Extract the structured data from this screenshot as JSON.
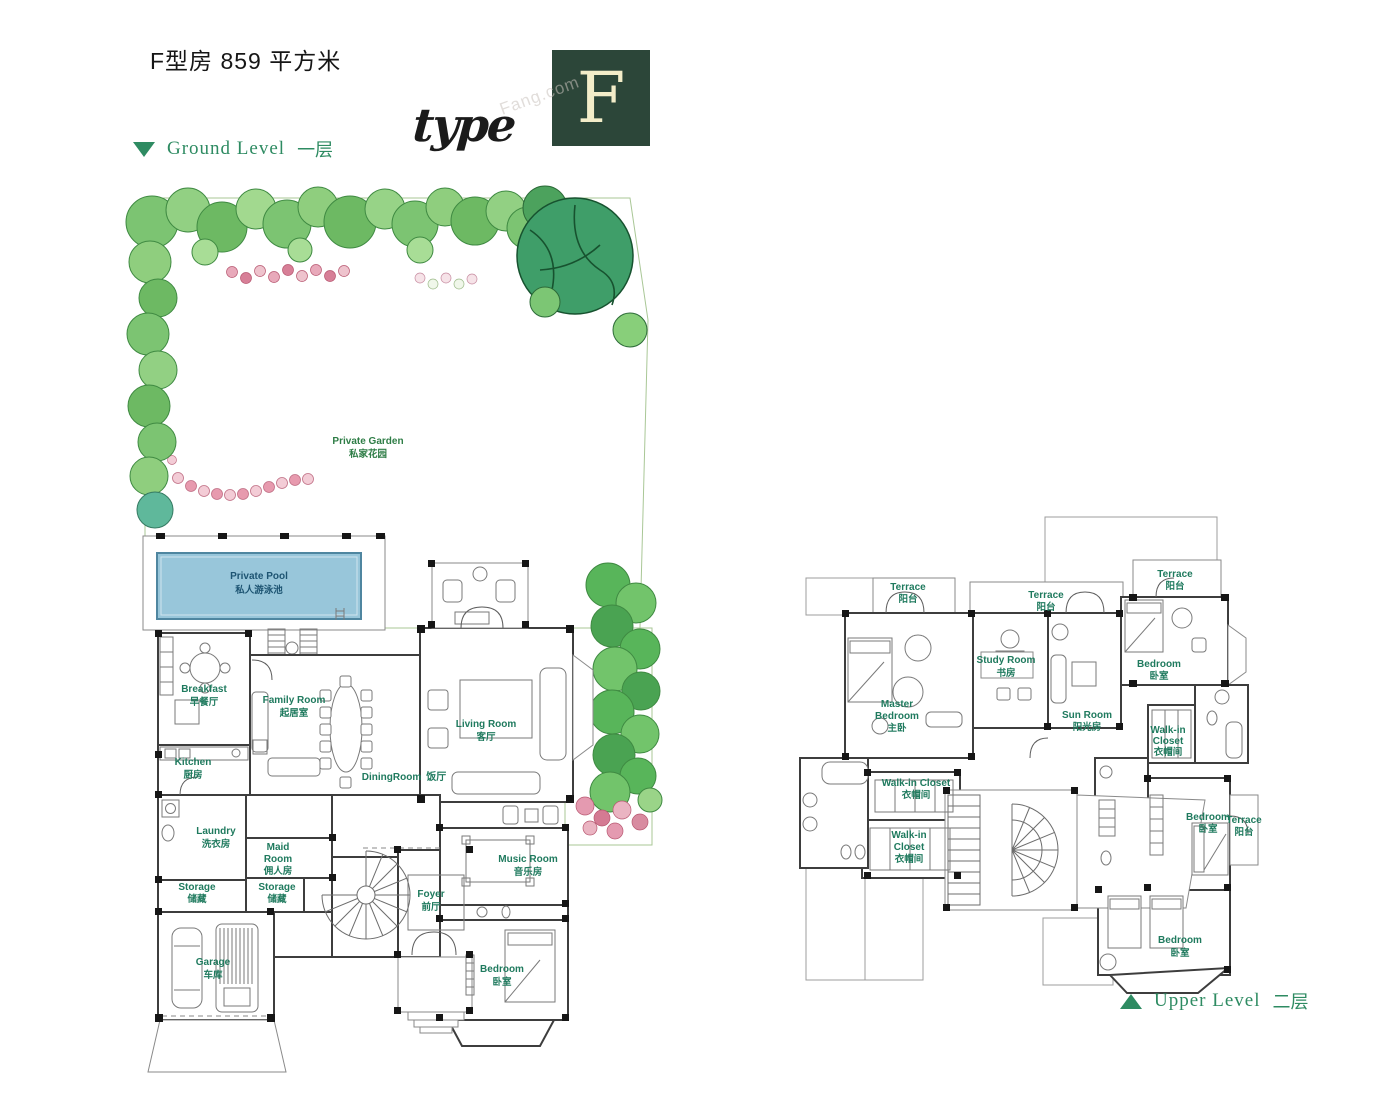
{
  "header": {
    "title": "F型房 859 平方米",
    "type_word": "type",
    "type_letter": "F",
    "watermark": "Fang.com"
  },
  "legend": {
    "ground_en": "Ground Level",
    "ground_zh": "一层",
    "upper_en": "Upper Level",
    "upper_zh": "二层"
  },
  "colors": {
    "accent_green": "#2e8b62",
    "label_green": "#1f7a5e",
    "garden_green": "#2e7d46",
    "pool_blue": "#98c6da",
    "pool_text": "#1d5472",
    "lawn": "#dfeecf",
    "logo_bg": "#2c4639",
    "logo_letter": "#f3edc9"
  },
  "ground": {
    "garden": {
      "en": "Private Garden",
      "zh": "私家花园"
    },
    "pool": {
      "en": "Private Pool",
      "zh": "私人游泳池"
    },
    "breakfast": {
      "en": "Breakfast",
      "zh": "早餐厅"
    },
    "family_room": {
      "en": "Family Room",
      "zh": "起居室"
    },
    "kitchen": {
      "en": "Kitchen",
      "zh": "厨房"
    },
    "dining_room": {
      "en": "DiningRoom",
      "zh": "饭厅"
    },
    "living_room": {
      "en": "Living Room",
      "zh": "客厅"
    },
    "laundry": {
      "en": "Laundry",
      "zh": "洗衣房"
    },
    "maid_room": {
      "en1": "Maid",
      "en2": "Room",
      "zh": "佣人房"
    },
    "storage_left": {
      "en": "Storage",
      "zh": "储藏"
    },
    "storage_center": {
      "en": "Storage",
      "zh": "储藏"
    },
    "garage": {
      "en": "Garage",
      "zh": "车库"
    },
    "foyer": {
      "en": "Foyer",
      "zh": "前厅"
    },
    "music_room": {
      "en": "Music Room",
      "zh": "音乐房"
    },
    "bedroom": {
      "en": "Bedroom",
      "zh": "卧室"
    }
  },
  "upper": {
    "terrace_top_left": {
      "en": "Terrace",
      "zh": "阳台"
    },
    "terrace_top_center": {
      "en": "Terrace",
      "zh": "阳台"
    },
    "terrace_top_right": {
      "en": "Terrace",
      "zh": "阳台"
    },
    "master_bedroom": {
      "en1": "Master",
      "en2": "Bedroom",
      "zh": "主卧"
    },
    "study_room": {
      "en": "Study Room",
      "zh": "书房"
    },
    "sun_room": {
      "en": "Sun Room",
      "zh": "阳光房"
    },
    "bedroom_top_right": {
      "en": "Bedroom",
      "zh": "卧室"
    },
    "walkin_right": {
      "en1": "Walk-in",
      "en2": "Closet",
      "zh": "衣帽间"
    },
    "walkin_center_upper": {
      "en": "Walk-in Closet",
      "zh": "衣帽间"
    },
    "walkin_center_lower": {
      "en1": "Walk-in",
      "en2": "Closet",
      "zh": "衣帽间"
    },
    "bedroom_mid_right": {
      "en": "Bedroom",
      "zh": "卧室"
    },
    "terrace_mid_right": {
      "en": "Terrace",
      "zh": "阳台"
    },
    "bedroom_bottom": {
      "en": "Bedroom",
      "zh": "卧室"
    }
  }
}
